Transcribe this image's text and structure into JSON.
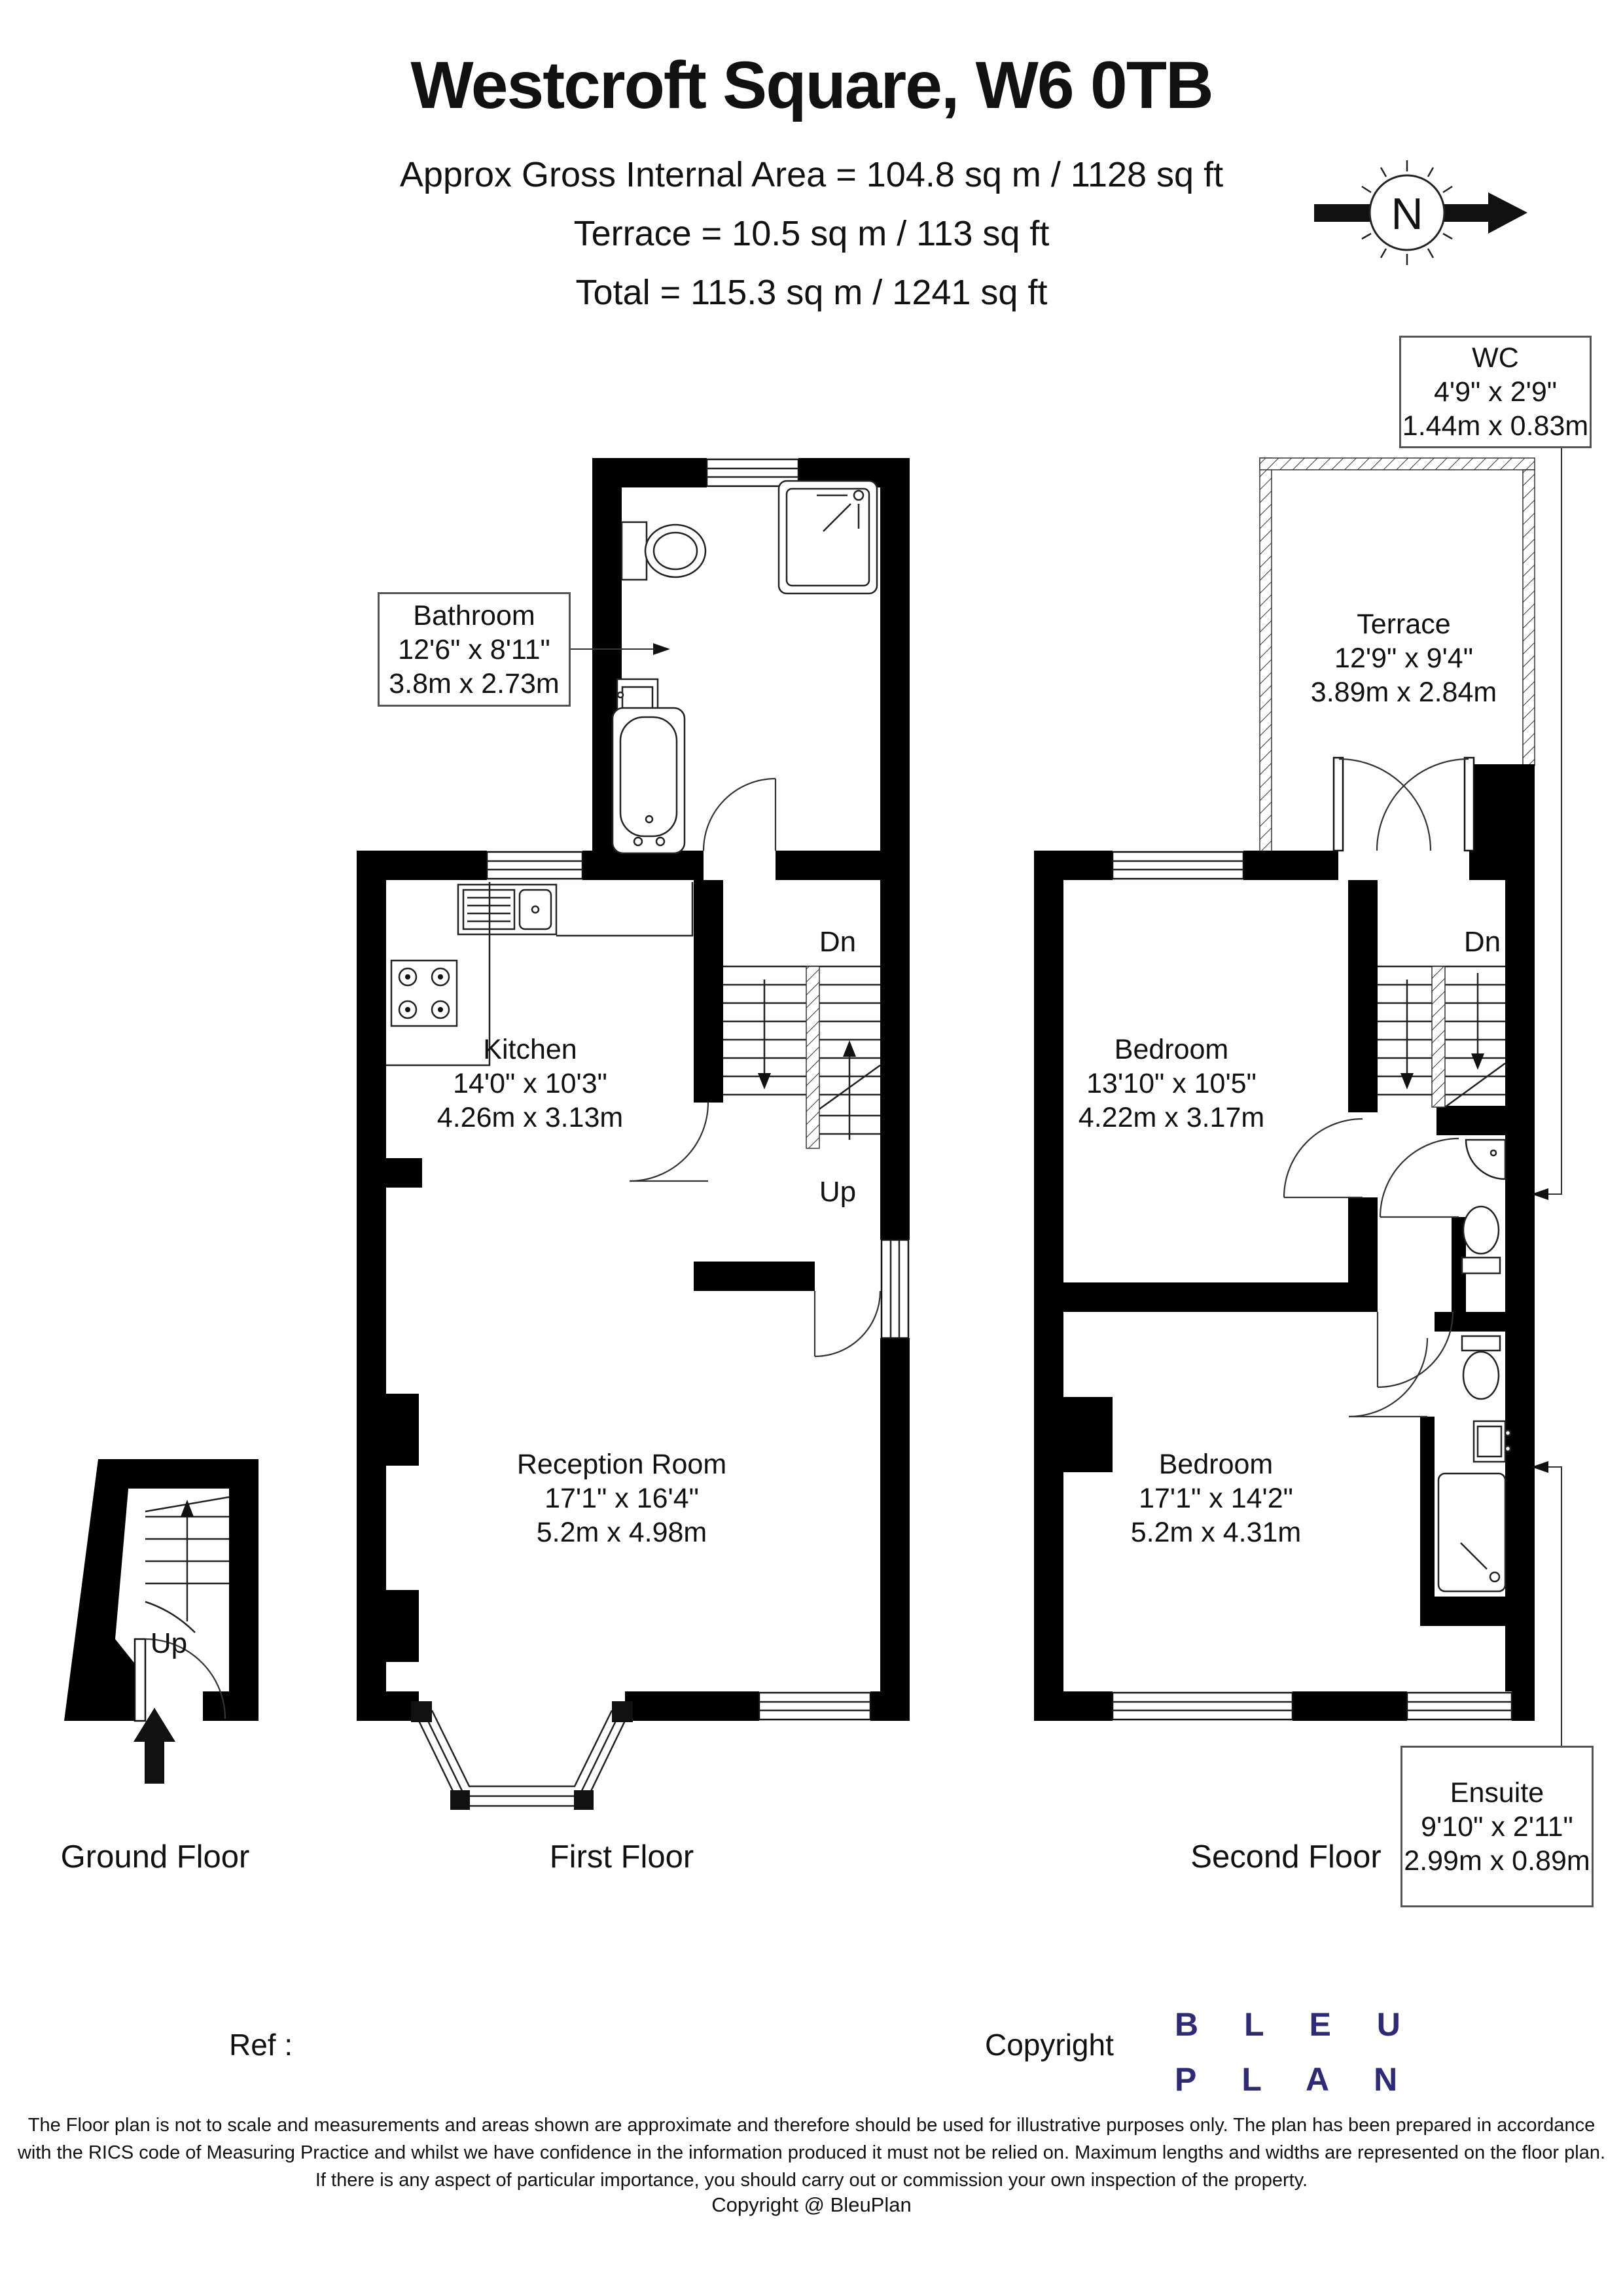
{
  "header": {
    "title": "Westcroft Square, W6 0TB",
    "line1": "Approx Gross Internal Area = 104.8 sq m / 1128 sq ft",
    "line2": "Terrace = 10.5 sq m / 113 sq ft",
    "line3": "Total = 115.3 sq m / 1241 sq ft"
  },
  "compass": {
    "label": "N"
  },
  "rooms": {
    "wc": {
      "name": "WC",
      "imperial": "4'9\" x 2'9\"",
      "metric": "1.44m x 0.83m"
    },
    "bathroom": {
      "name": "Bathroom",
      "imperial": "12'6\" x 8'11\"",
      "metric": "3.8m x 2.73m"
    },
    "terrace": {
      "name": "Terrace",
      "imperial": "12'9\" x 9'4\"",
      "metric": "3.89m x 2.84m"
    },
    "kitchen": {
      "name": "Kitchen",
      "imperial": "14'0\" x 10'3\"",
      "metric": "4.26m x 3.13m"
    },
    "bedroom_top": {
      "name": "Bedroom",
      "imperial": "13'10\" x 10'5\"",
      "metric": "4.22m x 3.17m"
    },
    "reception": {
      "name": "Reception Room",
      "imperial": "17'1\" x 16'4\"",
      "metric": "5.2m x 4.98m"
    },
    "bedroom_bottom": {
      "name": "Bedroom",
      "imperial": "17'1\" x 14'2\"",
      "metric": "5.2m x 4.31m"
    },
    "ensuite": {
      "name": "Ensuite",
      "imperial": "9'10\" x 2'11\"",
      "metric": "2.99m x 0.89m"
    }
  },
  "stairs": {
    "dn": "Dn",
    "up": "Up"
  },
  "floors": {
    "ground": "Ground Floor",
    "first": "First Floor",
    "second": "Second Floor"
  },
  "footer": {
    "ref_label": "Ref :",
    "copyright_label": "Copyright",
    "brand": {
      "line1": "B L E U",
      "line2": "P L A N",
      "color": "#2e2a78"
    },
    "disclaimer_line1": "The Floor plan is not to scale and measurements and areas shown are approximate and therefore should be used for illustrative purposes only. The plan has been prepared in accordance",
    "disclaimer_line2": "with the RICS code of Measuring Practice and whilst we have confidence in the information produced it must not be relied on. Maximum lengths and widths are represented on the floor plan.",
    "disclaimer_line3": "If there is any aspect of particular importance, you should carry out or commission your own inspection of the property.",
    "copyright_line": "Copyright @ BleuPlan"
  }
}
